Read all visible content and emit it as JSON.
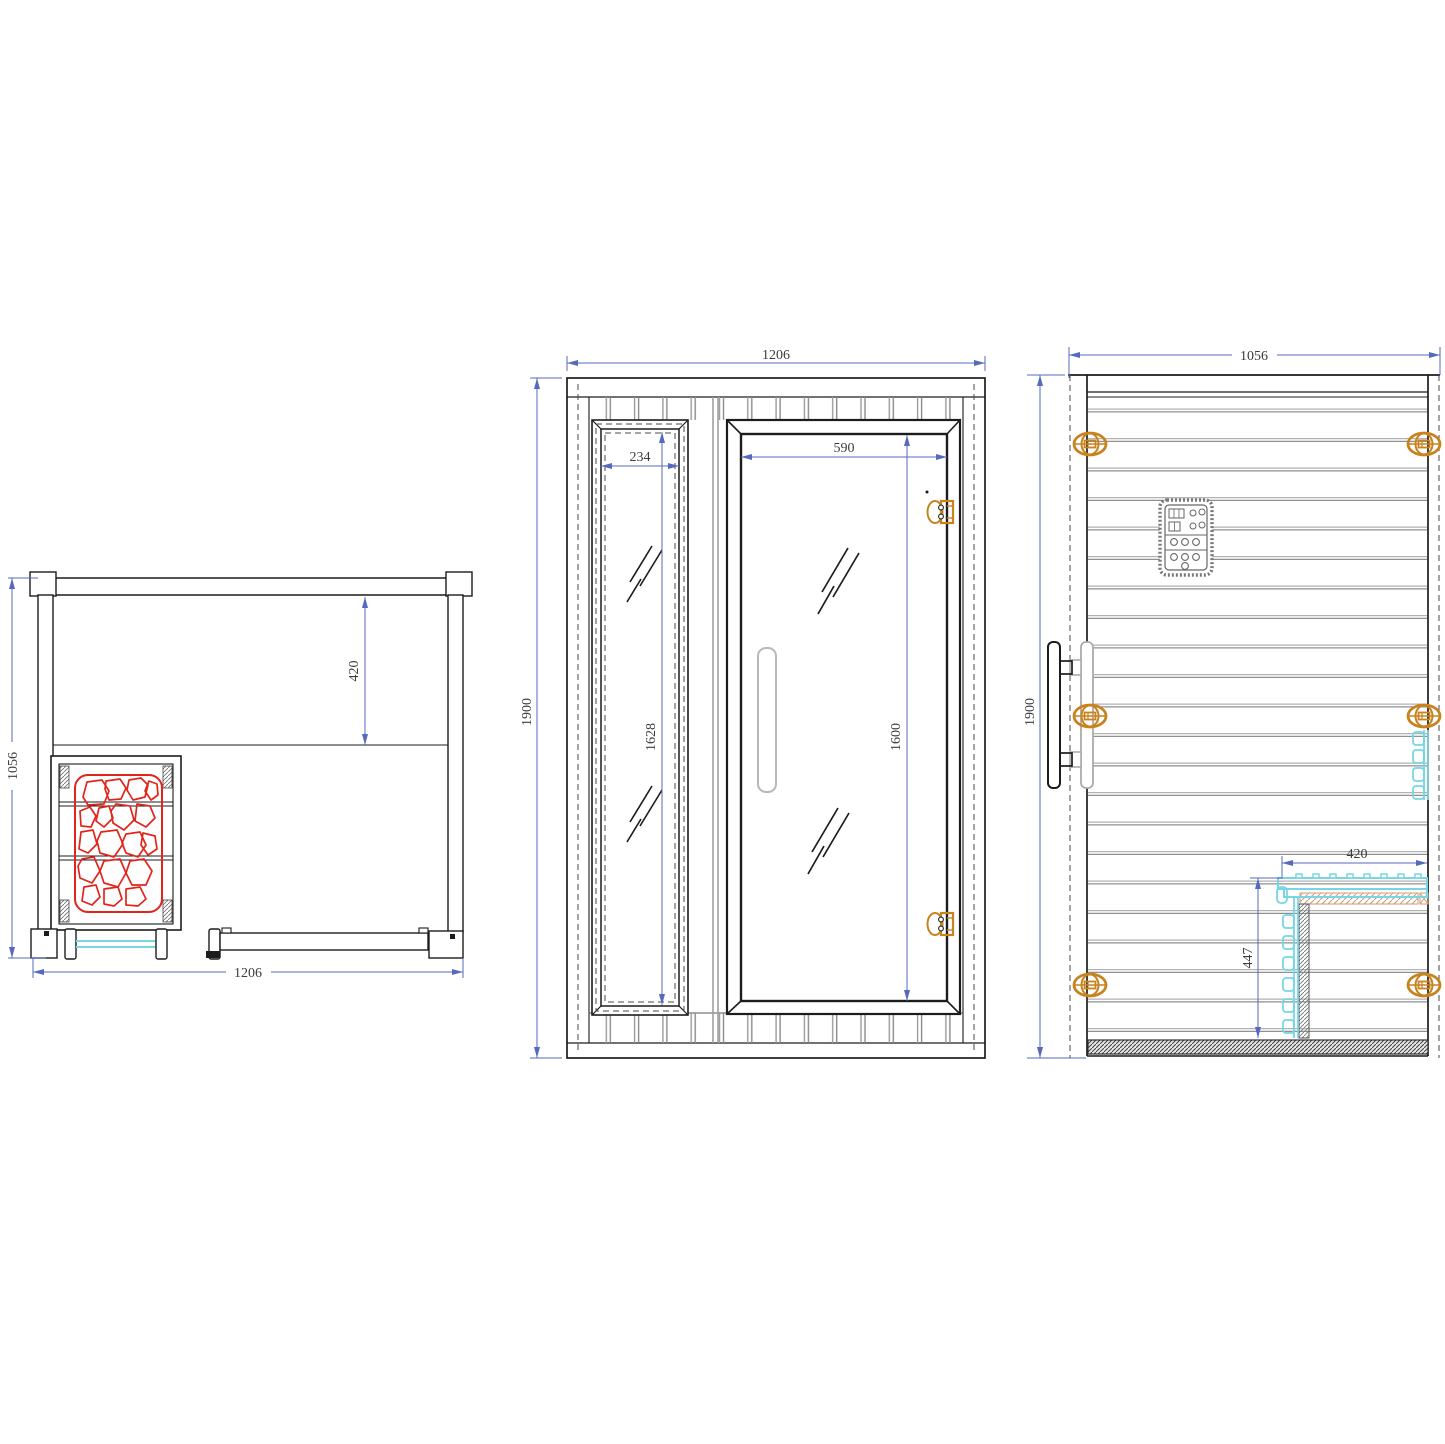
{
  "drawing": {
    "kind": "technical-orthographic-drawing",
    "subject": "sauna cabin three-view dimensional drawing",
    "units": "mm",
    "views": {
      "top": {
        "name": "top-plan-view",
        "dims": {
          "depth": "1056",
          "bench_depth": "420",
          "width": "1206"
        }
      },
      "front": {
        "name": "front-elevation",
        "dims": {
          "width": "1206",
          "height": "1900",
          "window_width": "234",
          "window_glass_height": "1628",
          "door_width": "590",
          "door_glass_height": "1600"
        }
      },
      "side": {
        "name": "side-elevation",
        "dims": {
          "width": "1056",
          "height": "1900",
          "bench_depth": "420",
          "bench_height": "447"
        }
      }
    },
    "colors": {
      "dimension_blue": "#5569bd",
      "outline_black": "#1c1c1c",
      "plank_gray": "#9a9a9a",
      "glass_cyan": "#76d6e4",
      "hinge_orange": "#c8821e",
      "heater_stone_red": "#e1251b",
      "bench_hatch_tan": "#cf9a78"
    }
  }
}
